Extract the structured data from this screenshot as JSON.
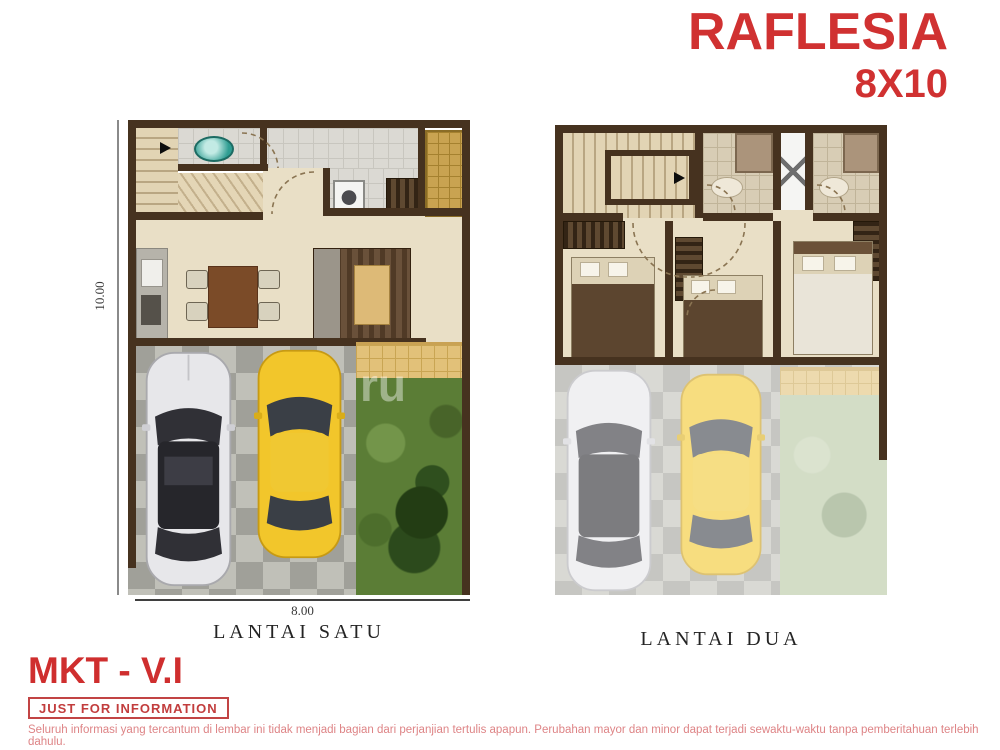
{
  "title": {
    "name": "RAFLESIA",
    "size": "8X10"
  },
  "plan_first": {
    "label": "LANTAI SATU",
    "width_dim": "8.00",
    "height_dim": "10.00"
  },
  "plan_second": {
    "label": "LANTAI DUA"
  },
  "footer": {
    "brand": "MKT - V.I",
    "stamp": "JUST FOR INFORMATION",
    "disclaimer": "Seluruh informasi yang tercantum di lembar ini tidak menjadi bagian dari perjanjian tertulis apapun. Perubahan mayor dan minor dapat terjadi sewaktu-waktu tanpa pemberitahuan terlebih dahulu."
  },
  "watermark_fragment": "ru",
  "colors": {
    "accent_red": "#d03131",
    "wall_brown": "#46321f",
    "floor_cream": "#e9dfc6",
    "tile_gray": "#dbd9d3",
    "paving_gray": "#a0a099",
    "garden_green": "#5b7d36",
    "car_yellow": "#f2c62b",
    "car_silver": "#e7e7ea",
    "gold_cabinet": "#c9a351",
    "toilet_teal": "#2f9d92"
  }
}
